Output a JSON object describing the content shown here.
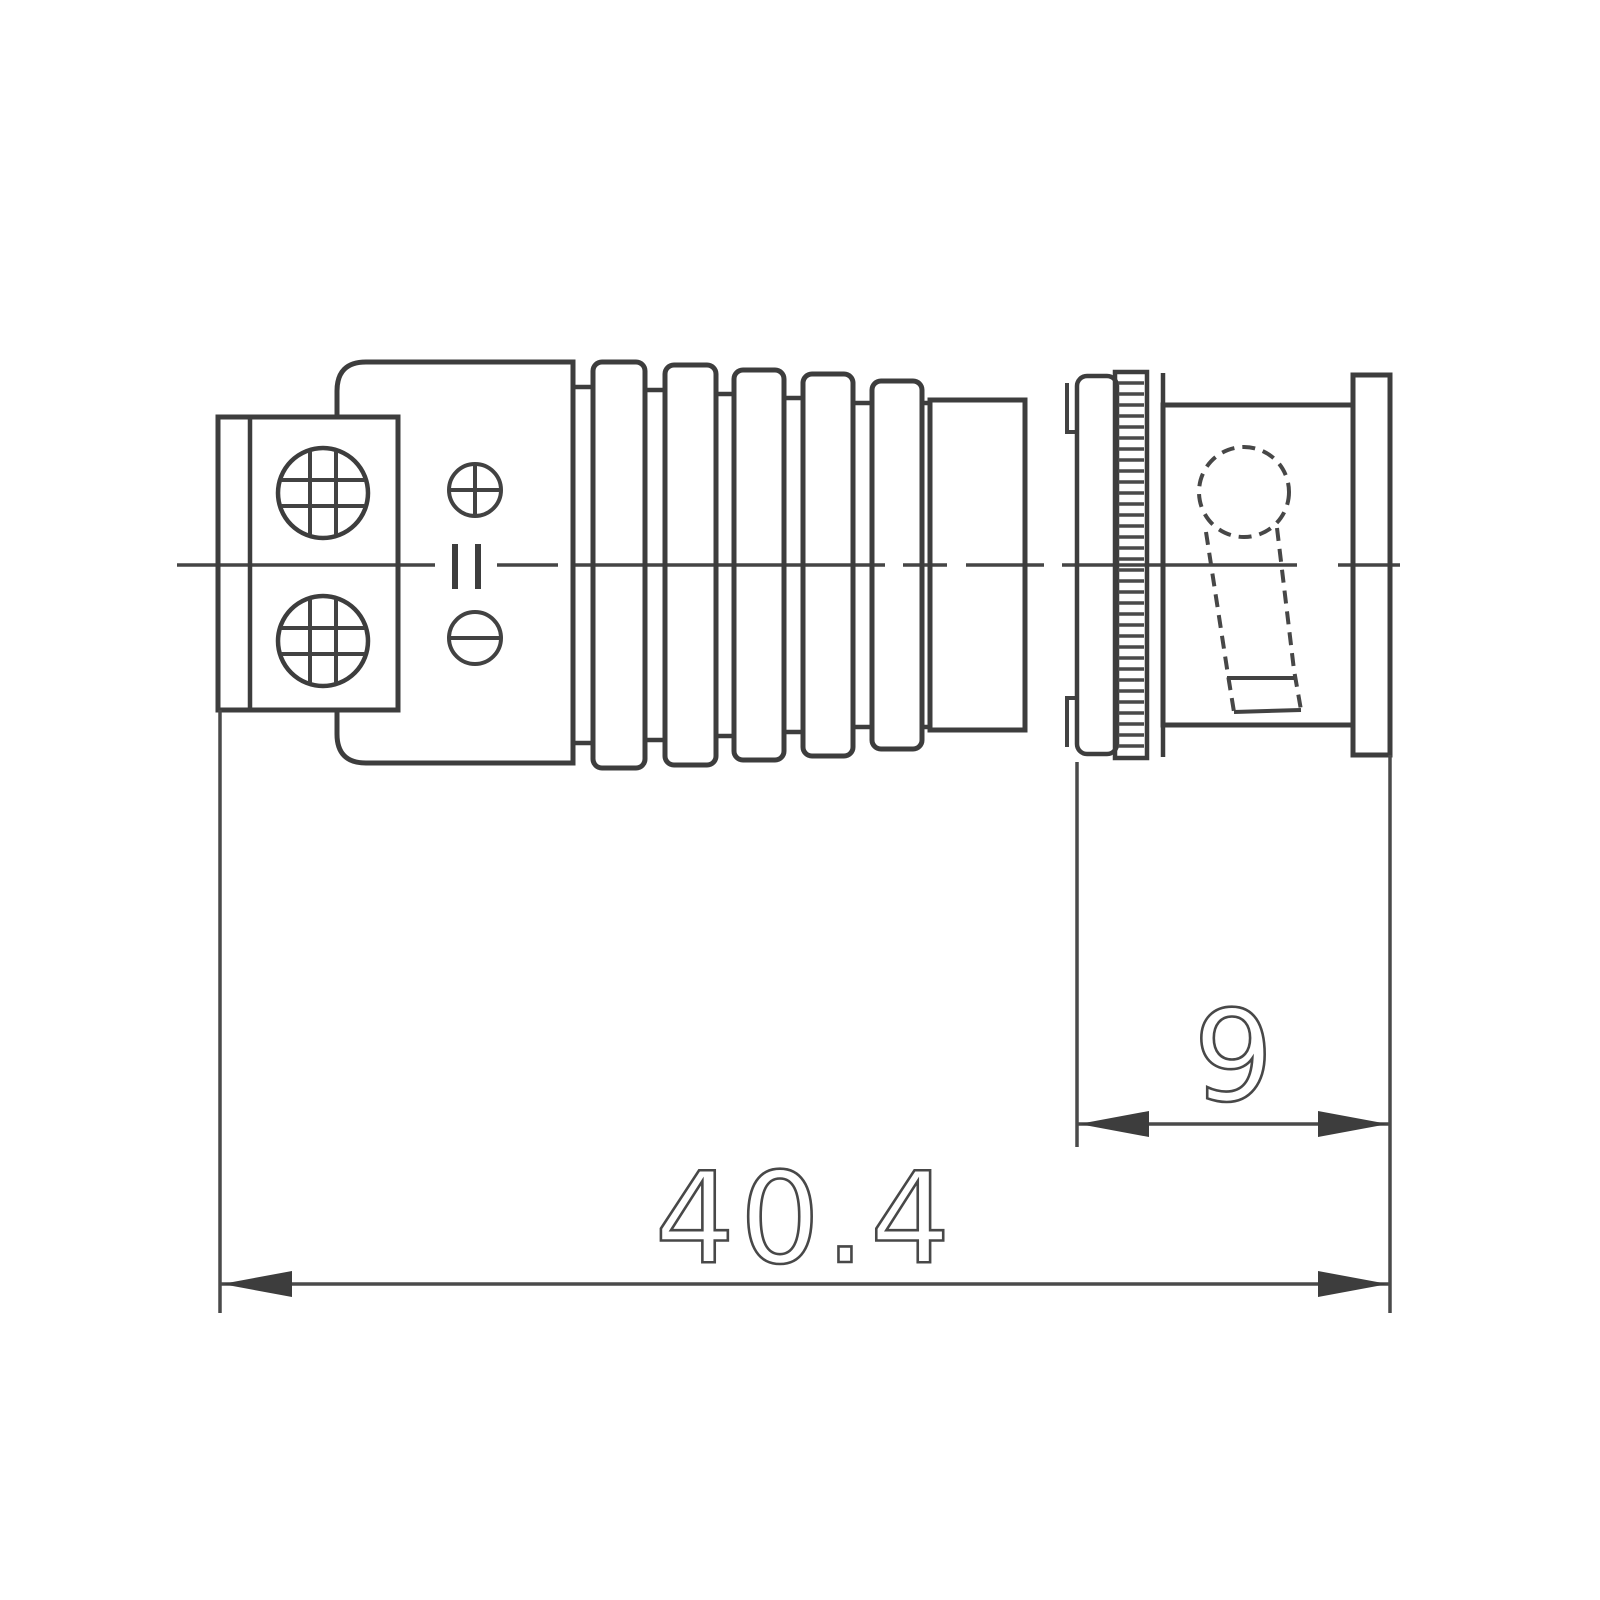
{
  "drawing": {
    "background_color": "#ffffff",
    "line_color": "#3d3d3d",
    "dim_line_color": "#4a4a4a",
    "dimensions": {
      "overall_length": {
        "value": "40.4"
      },
      "bnc_body_length": {
        "value": "9"
      }
    }
  }
}
